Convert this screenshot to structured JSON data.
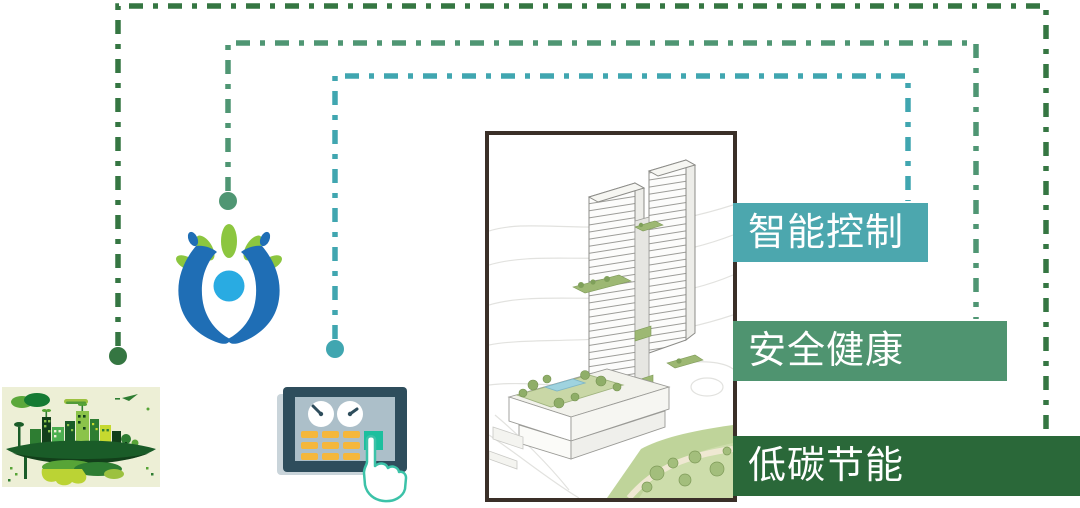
{
  "canvas": {
    "width": 1080,
    "height": 508,
    "background": "#FFFFFF"
  },
  "labels": [
    {
      "text": "智能控制",
      "bar_color": "#4CA7AE",
      "line_color": "#40A6B0",
      "text_color": "#FFFFFF",
      "linked_icon": "control-panel-icon"
    },
    {
      "text": "安全健康",
      "bar_color": "#4F9470",
      "line_color": "#4F9673",
      "text_color": "#FFFFFF",
      "linked_icon": "hands-care-icon"
    },
    {
      "text": "低碳节能",
      "bar_color": "#2A6839",
      "line_color": "#357642",
      "text_color": "#FFFFFF",
      "linked_icon": "eco-city-icon"
    }
  ],
  "building_image": {
    "name": "tower-architecture-rendering",
    "frame_color": "#3A2F28"
  },
  "icons": {
    "eco_city": {
      "background": "#EDEFD6",
      "island_color": "#1A5C28",
      "building_greens": [
        "#123F1A",
        "#2E7D32",
        "#4CAF50",
        "#8BC34A",
        "#C6D92F"
      ],
      "underside_color": "#BBD334"
    },
    "hands_care": {
      "hand_color": "#1F6EB5",
      "head_color": "#29ABE2",
      "leaf_color": "#8CC63F"
    },
    "control_panel": {
      "frame_color": "#2E4D5C",
      "screen_color": "#ACBFC9",
      "button_color": "#F5B73B",
      "accent_button_color": "#1CBF9E",
      "hand_outline_color": "#3CC2A8"
    }
  }
}
